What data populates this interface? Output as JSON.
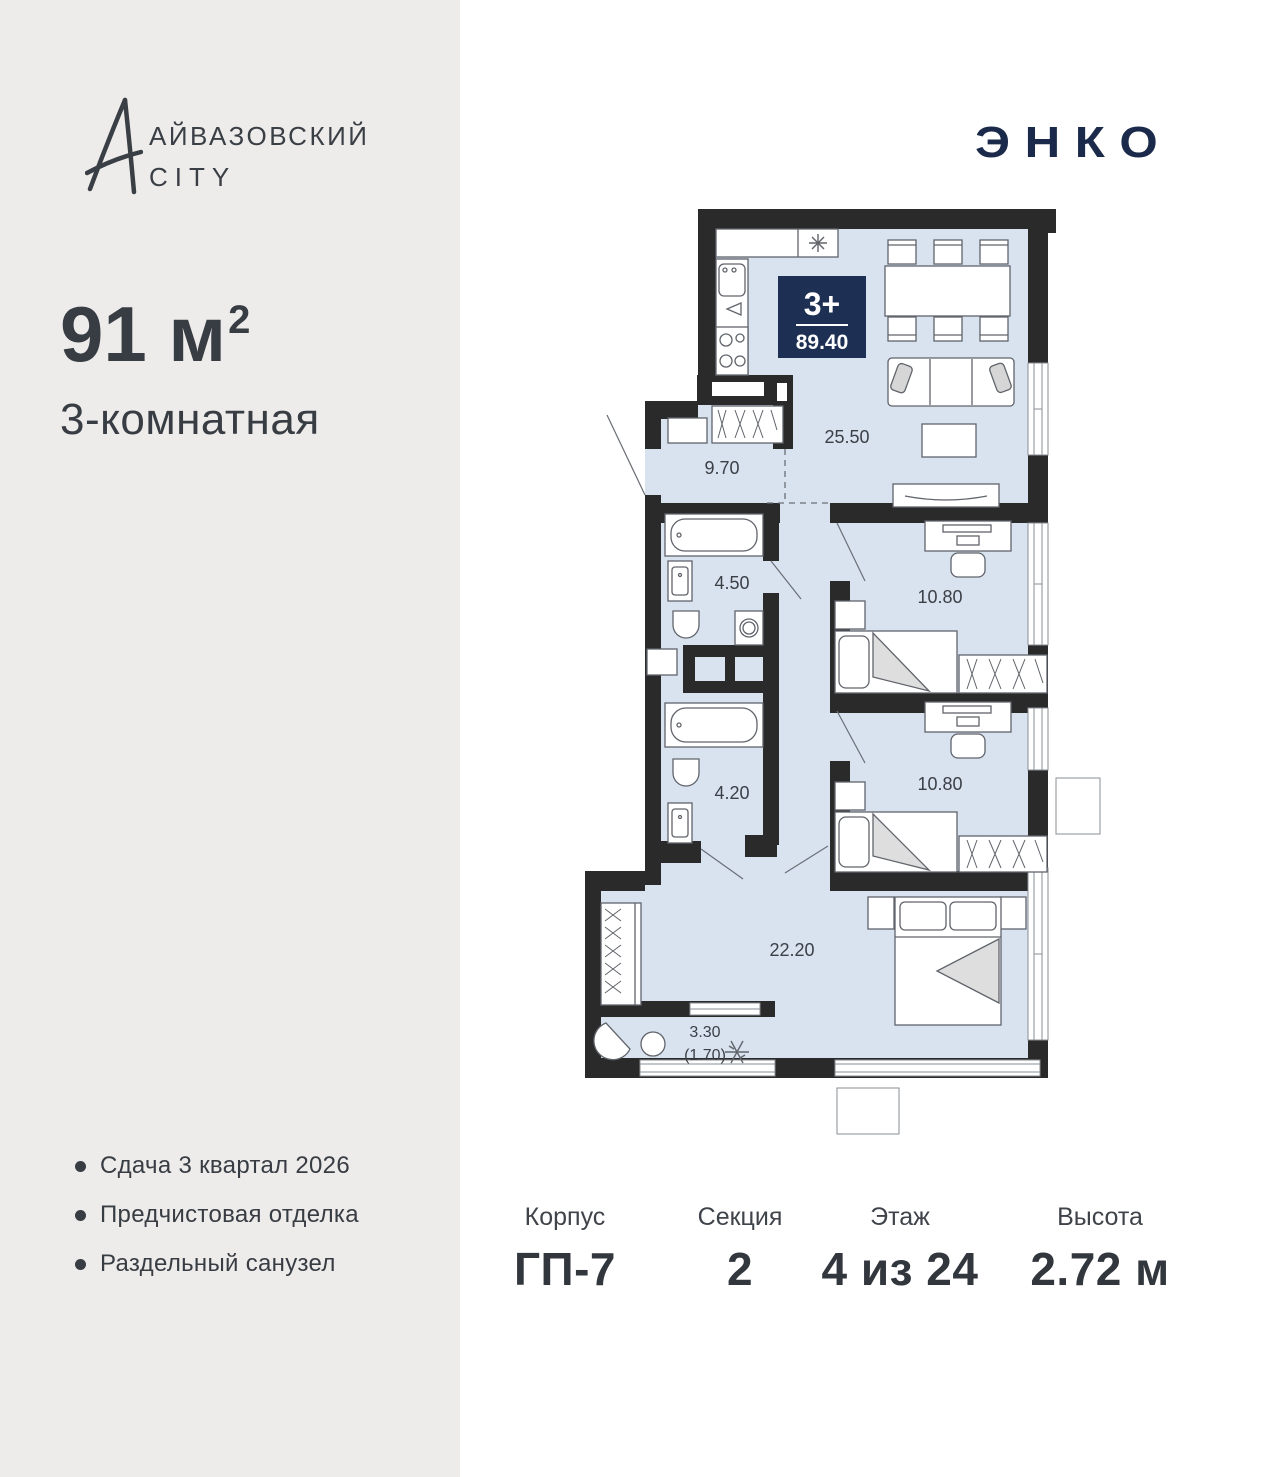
{
  "brand": {
    "logo_text": "АЙВАЗОВСКИЙ",
    "logo_sub": "CITY"
  },
  "developer": {
    "logo_text": "ЭНКО"
  },
  "offer": {
    "area_value": "91",
    "area_unit": " м",
    "area_exponent": "2",
    "type_label": "3-комнатная"
  },
  "features": [
    "Сдача 3 квартал 2026",
    "Предчистовая отделка",
    "Раздельный санузел"
  ],
  "plan": {
    "badge": {
      "rooms": "3+",
      "total_area": "89.40"
    },
    "labels": {
      "living": "25.50",
      "hallway": "9.70",
      "bath1": "4.50",
      "bedroom1": "10.80",
      "bath2": "4.20",
      "bedroom2": "10.80",
      "corridor": "22.20",
      "loggia": "3.30",
      "loggia_reduced": "(1.70)"
    }
  },
  "details": [
    {
      "label": "Корпус",
      "value": "ГП-7"
    },
    {
      "label": "Секция",
      "value": "2"
    },
    {
      "label": "Этаж",
      "value": "4 из 24"
    },
    {
      "label": "Высота",
      "value": "2.72 м"
    }
  ],
  "colors": {
    "accent": "#1d3054",
    "wall": "#2a2a2a",
    "floor": "#d9e2ef",
    "panel": "#edecea",
    "text": "#3a3e45"
  }
}
